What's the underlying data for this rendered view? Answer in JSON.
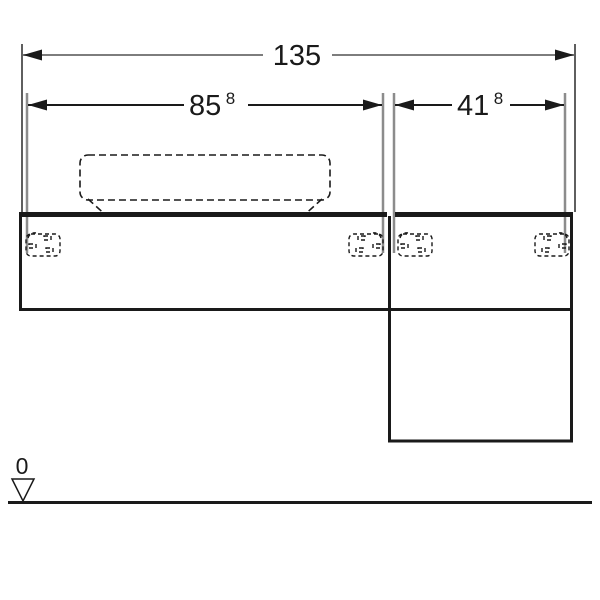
{
  "page": {
    "background": "#ffffff"
  },
  "drawing": {
    "type": "technical-dimension-drawing",
    "colors": {
      "primary_line": "#1a1a1a",
      "overall_dimension_line": "#7d7d7d",
      "extension_line": "#8c8c8c",
      "dashed_reference": "#1a1a1a"
    },
    "dimensions": {
      "overall": {
        "label": "135"
      },
      "left_unit": {
        "label": "85",
        "sup": "8"
      },
      "right_unit": {
        "label": "41",
        "sup": "8"
      }
    },
    "datum": {
      "label": "0"
    }
  }
}
